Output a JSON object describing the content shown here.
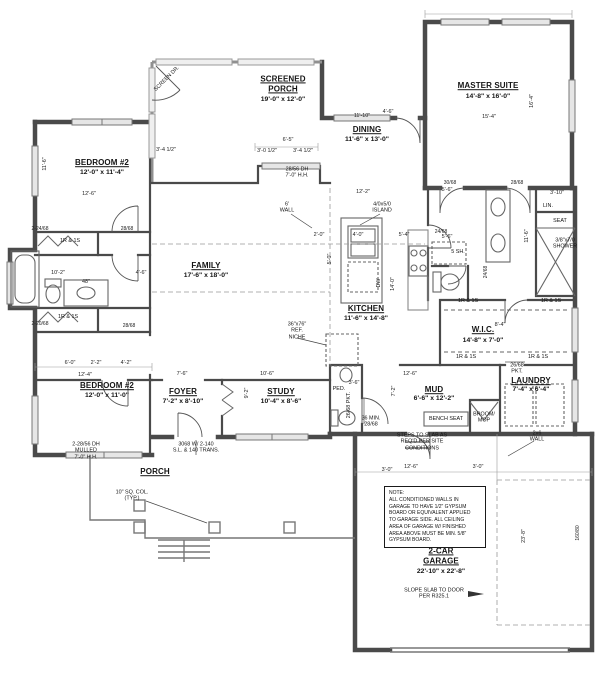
{
  "colors": {
    "wall": "#4a4a4a",
    "screen": "#909090",
    "window_fill": "#e6e6e6",
    "dash": "#999999",
    "text": "#141414"
  },
  "rooms": {
    "screened_porch": {
      "name": "SCREENED\nPORCH",
      "dims": "19'-0\" x 12'-0\""
    },
    "master": {
      "name": "MASTER SUITE",
      "dims": "14'-8\" x 16'-0\""
    },
    "dining": {
      "name": "DINING",
      "dims": "11'-6\" x 13'-0\""
    },
    "bedroom2_top": {
      "name": "BEDROOM #2",
      "dims": "12'-0\" x 11'-4\""
    },
    "family": {
      "name": "FAMILY",
      "dims": "17'-6\" x 18'-0\""
    },
    "kitchen": {
      "name": "KITCHEN",
      "dims": "11'-6\" x 14'-8\""
    },
    "wic": {
      "name": "W.I.C.",
      "dims": "14'-8\" x 7'-0\""
    },
    "bedroom2_bottom": {
      "name": "BEDROOM #2",
      "dims": "12'-0\" x 11'-0\""
    },
    "foyer": {
      "name": "FOYER",
      "dims": "7'-2\" x 8'-10\""
    },
    "study": {
      "name": "STUDY",
      "dims": "10'-4\" x 8'-6\""
    },
    "mud": {
      "name": "MUD",
      "dims": "6'-6\" x 12'-2\""
    },
    "laundry": {
      "name": "LAUNDRY",
      "dims": "7'-4\" x 6'-4\""
    },
    "porch": {
      "name": "PORCH"
    },
    "garage": {
      "name": "2-CAR\nGARAGE",
      "dims": "22'-10\" x 22'-8\""
    }
  },
  "ann": {
    "island": "4/0x5/0\nISLAND",
    "wall6": "6'\nWALL",
    "ref_niche": "36\"x76\"\nREF.\nNICHE",
    "dw": "DW",
    "bench": "BENCH SEAT",
    "broom": "BROOM/\nMOP",
    "pkt": "26/68\nPKT.",
    "pkt2": "26/68 PKT.",
    "steps": "STEPS TO SLAB AS\nREQ'D PER SITE\nCONDITIONS",
    "slope": "SLOPE SLAB TO DOOR\nPER R325.1",
    "col": "10\" SQ. COL.\n(TYP.)",
    "mulled": "2-28/56 DH\nMULLED\n7'-0\" H.H.",
    "front_door": "3068 W/ 2-140\nS.L. & 140 TRANS.",
    "porch_win": "28/56 DH\n7'-0\" H.H.",
    "wall2x6": "2x6\nWALL",
    "screen_door": "SCREEN DR.",
    "ped": "PED.",
    "min_door": "36 MIN.\n28/68",
    "seat": "SEAT",
    "shower": "3/8\"x7/0\nSHOWER",
    "lin": "LIN.",
    "shelves5": "5 SH.",
    "shelf": "1R & 1S",
    "note": "NOTE:\nALL CONDITIONED WALLS IN\nGARAGE TO HAVE 1/2\" GYPSUM\nBOARD OR EQUIVALENT APPLIED\nTO GARAGE SIDE. ALL CEILING\nAREA OF GARAGE W/ FINISHED\nAREA ABOVE MUST BE MIN. 5/8\"\nGYPSUM BOARD."
  },
  "doors": {
    "d3068": "30/68",
    "d2868": "28/68",
    "d2468": "24/68",
    "d2_2468": "2-24/68",
    "d2_2068": "2-20/68",
    "garage_door": "160/80"
  },
  "dims": {
    "dining_w": "11'-10\"",
    "master_w": "15'-4\"",
    "master_h": "16'-4\"",
    "br2t_w": "12'-6\"",
    "br2t_h": "11'-6\"",
    "porch65": "6'-5\"",
    "porch_a": "3'-0 1/2\"",
    "porch_b": "3'-4 1/2\"",
    "hall_b": "3'-4 1/2\"",
    "kit_w": "12'-2\"",
    "kit_2": "2'-0\"",
    "kit_4": "4'-0\"",
    "kit_54": "5'-4\"",
    "kit_5": "5'-0\"",
    "kit_h": "14'-0\"",
    "wic_w": "8'-4\"",
    "mud_w": "12'-6\"",
    "mud_36": "3'-6\"",
    "mud_h": "7'-2\"",
    "mud_bw": "12'-6\"",
    "mud_b3": "3'-0\"",
    "foyer_w": "7'-6\"",
    "study_w": "10'-6\"",
    "study_h": "9'-2\"",
    "br2b_6": "6'-0\"",
    "br2b_22": "2'-2\"",
    "br2b_42": "4'-2\"",
    "br2b_w": "12'-4\"",
    "gar_h": "23'-8\"",
    "right_h": "11'-6\"",
    "v56a": "5'-6\"",
    "v56b": "5'-6\"",
    "v310": "3'-10\"",
    "bath46": "4'-6\"",
    "van48": "48\"",
    "bath102": "10'-2\"",
    "din46": "4'-6\"",
    "gar3": "3'-0\""
  }
}
